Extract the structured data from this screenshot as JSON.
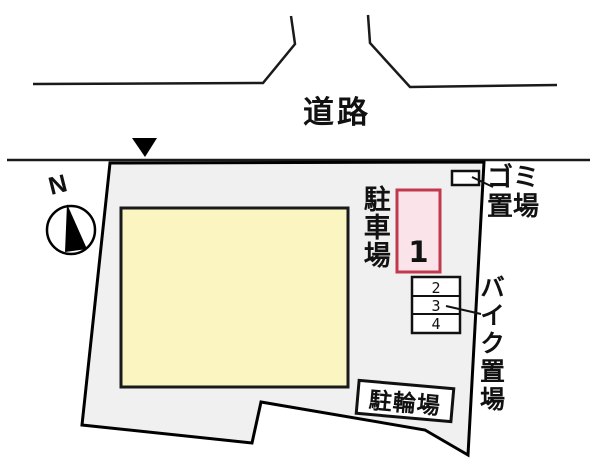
{
  "plan": {
    "type": "property-site-layout",
    "labels": {
      "road": "道路",
      "garbage": {
        "line1": "ゴミ",
        "line2": "置場",
        "full": "ゴミ置場"
      },
      "parking_area": "駐車場",
      "parking_space_1": "1",
      "bike_area": "バイク置場",
      "bike_space_2": "2",
      "bike_space_3": "3",
      "bike_space_4": "4",
      "bicycle_parking": "駐輪場",
      "north": "N"
    },
    "colors": {
      "background": "#ffffff",
      "site_fill": "#f0f0f0",
      "site_border": "#000000",
      "building_fill": "#fbf5c2",
      "building_border": "#1a1a1a",
      "parking_space_fill": "#fbe3ea",
      "parking_space_border": "#c2394e",
      "box_fill": "#ffffff",
      "line_color": "#1a1a1a"
    }
  }
}
